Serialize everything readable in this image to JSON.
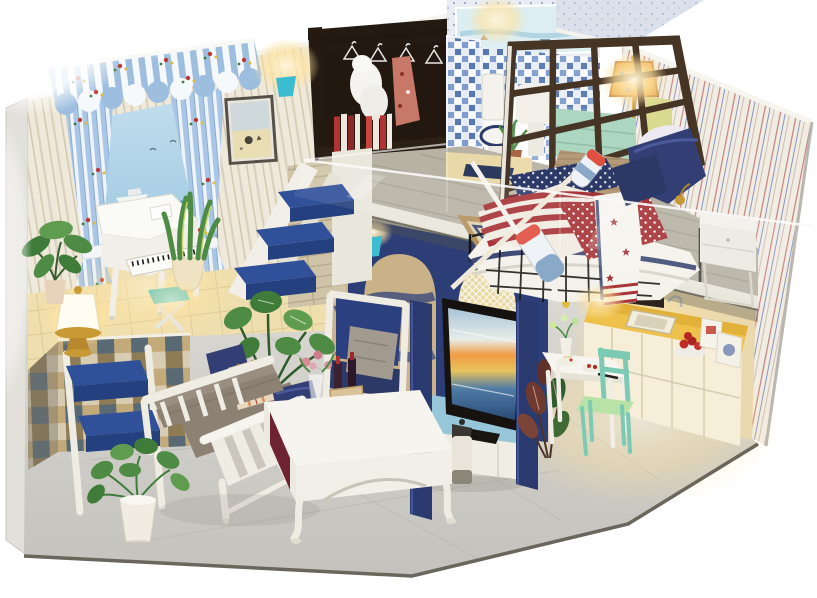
{
  "scene": {
    "title": "Miniature DIY dollhouse room box — coastal nautical loft apartment with warm lights, photographed on a white background",
    "levels": [
      {
        "name": "ground-floor",
        "areas": [
          {
            "name": "piano-lounge",
            "items": [
              "blue striped awning with floral trim",
              "blue-and-white tied curtains",
              "beach mural with speedboat and palm",
              "white grand piano",
              "teal x-base piano stool",
              "brass lantern lamp",
              "snake plant in cream pot",
              "ficus plant",
              "mosaic-tiled raised platform",
              "white step ladder with royal-blue treads"
            ]
          },
          {
            "name": "living-room",
            "items": [
              "white slatted bench sofa",
              "gray bolster cushions",
              "navy throw pillows",
              "orange plaid pillow",
              "white coffee table with maroon side panel",
              "glass vase of pink roses",
              "wine crate with bottles",
              "navy armchair with gray pillow",
              "monstera in black vase",
              "pothos in white pot",
              "framed beach print"
            ]
          },
          {
            "name": "media-corner",
            "items": [
              "navy arched partition",
              "golden mesh net arch",
              "wave mosaic wall",
              "teal wall sconce",
              "flat-screen tv showing ocean sunset",
              "blue-topped white tv cabinet",
              "lighthouse canister"
            ]
          },
          {
            "name": "kitchen-dining",
            "items": [
              "mustard countertop",
              "white cabinet fronts",
              "inset sink with faucet",
              "plate of red apples",
              "food cartons",
              "dark wall oven",
              "white dining table with desserts",
              "mint-green chair",
              "dark-leaf calathea plant"
            ]
          }
        ]
      },
      {
        "name": "loft-floor",
        "areas": [
          {
            "name": "bedroom",
            "items": [
              "white boat-shaped bed",
              "american-flag style quilt",
              "knitted tan throw",
              "navy pillows",
              "star-print white throw",
              "crossed rowing oars",
              "ornate bordered rug",
              "white nightstand",
              "stained-glass bedside lamp",
              "seafoam dresser",
              "dark lattice screen",
              "pinstriped wallpaper",
              "clear acrylic railing"
            ]
          },
          {
            "name": "dressing-nook",
            "items": [
              "dark open wardrobe rack",
              "wire hangers",
              "white fur coat",
              "red floral dress",
              "stacked red-and-white books"
            ]
          },
          {
            "name": "bathroom",
            "items": [
              "white toilet with navy seat",
              "pedestal basin",
              "blue mosaic tile wall",
              "seascape mural band",
              "potted grass plant",
              "navy bath mat"
            ]
          }
        ]
      },
      {
        "name": "structure",
        "items": [
          "striped cream left wall",
          "speckled blue gable",
          "gray plank loft floor with white fascia",
          "marble-look floor",
          "checkered platform tiles",
          "warm glowing mini lights"
        ]
      }
    ]
  },
  "palette": {
    "bg": "#ffffff",
    "wall_cream": "#efe9db",
    "wall_stripe": "#d9d1bd",
    "wall_trim": "#f7f5ef",
    "awning_blue": "#9dbede",
    "awning_white": "#f6f9fc",
    "curtain_blue": "#a9c6e6",
    "floral_red": "#bb3a34",
    "floral_yellow": "#e0bc3c",
    "floral_green": "#3f7c3a",
    "mural_sand": "#e9ddb4",
    "palm_green": "#2e6e3e",
    "platform_tile": "#f0dfae",
    "grout": "#d6c28c",
    "check_a": "#c3aa7a",
    "check_b": "#5a6a74",
    "check_c": "#8d7c55",
    "check_d": "#d8ccb2",
    "stair_blue": "#31509a",
    "stair_blue_dark": "#24407e",
    "white_wood": "#f1efe7",
    "plank": "#cfc4a8",
    "plank_line": "#b4a888",
    "mosaic_tan": "#c9b288",
    "mosaic_navy": "#3c4a7c",
    "mosaic_sky": "#9cc0d4",
    "navy_wall": "#2d3e76",
    "navy_post": "#2b3a6e",
    "net_gold": "#e7d9a6",
    "stand_blue": "#97c6d8",
    "tv_black": "#151210",
    "counter": "#d8a42e",
    "counter_lit": "#eec14a",
    "cabinet": "#f6eed8",
    "kitchen_wall": "#ead9ae",
    "mint": "#7cc9b4",
    "mint_seat": "#b9e2a6",
    "loft_floor": "#b7b2a4",
    "fascia": "#e9e6dc",
    "rug_cream": "#dcd2ae",
    "rug_navy": "#3a4472",
    "rug_border": "#b5915e",
    "pin_base": "#f2ede3",
    "pin_red": "#c08080",
    "pin_blue": "#8894c0",
    "gable_blue": "#ccd4e4",
    "lattice": "#463425",
    "bed_white": "#f4f2ea",
    "flag_red": "#a63438",
    "flag_navy": "#2d3a68",
    "knit": "#b49a78",
    "pillow_navy": "#333f74",
    "sofa_gray": "#9a8e80",
    "sofa_gray2": "#8d8174",
    "plaid_base": "#e8d8c0",
    "plaid_line": "#d08a4c",
    "armchair_navy": "#2c3f7e",
    "pillow_gray": "#a29a8e",
    "leaf": "#4e8c46",
    "leaf_dark": "#3f7c3a",
    "leaf_light": "#5f9c50",
    "pot_cream": "#ecdfc0",
    "terracotta": "#a75c38",
    "vase_black": "#1c1c1c",
    "teal_sconce": "#3cbcd0",
    "brass": "#c79a36",
    "brass_dark": "#b8882e",
    "marble": "#d6d4ce",
    "outer_wall": "#e2e0da",
    "maroon": "#6e2430",
    "dark_wood": "#241a12",
    "book_red": "#b03434",
    "glow_warm": "#ffe3a0",
    "seafoam": "#a8d4be",
    "lamp_amber": "#e8a84c",
    "toilet_navy": "#2c3a6a"
  }
}
